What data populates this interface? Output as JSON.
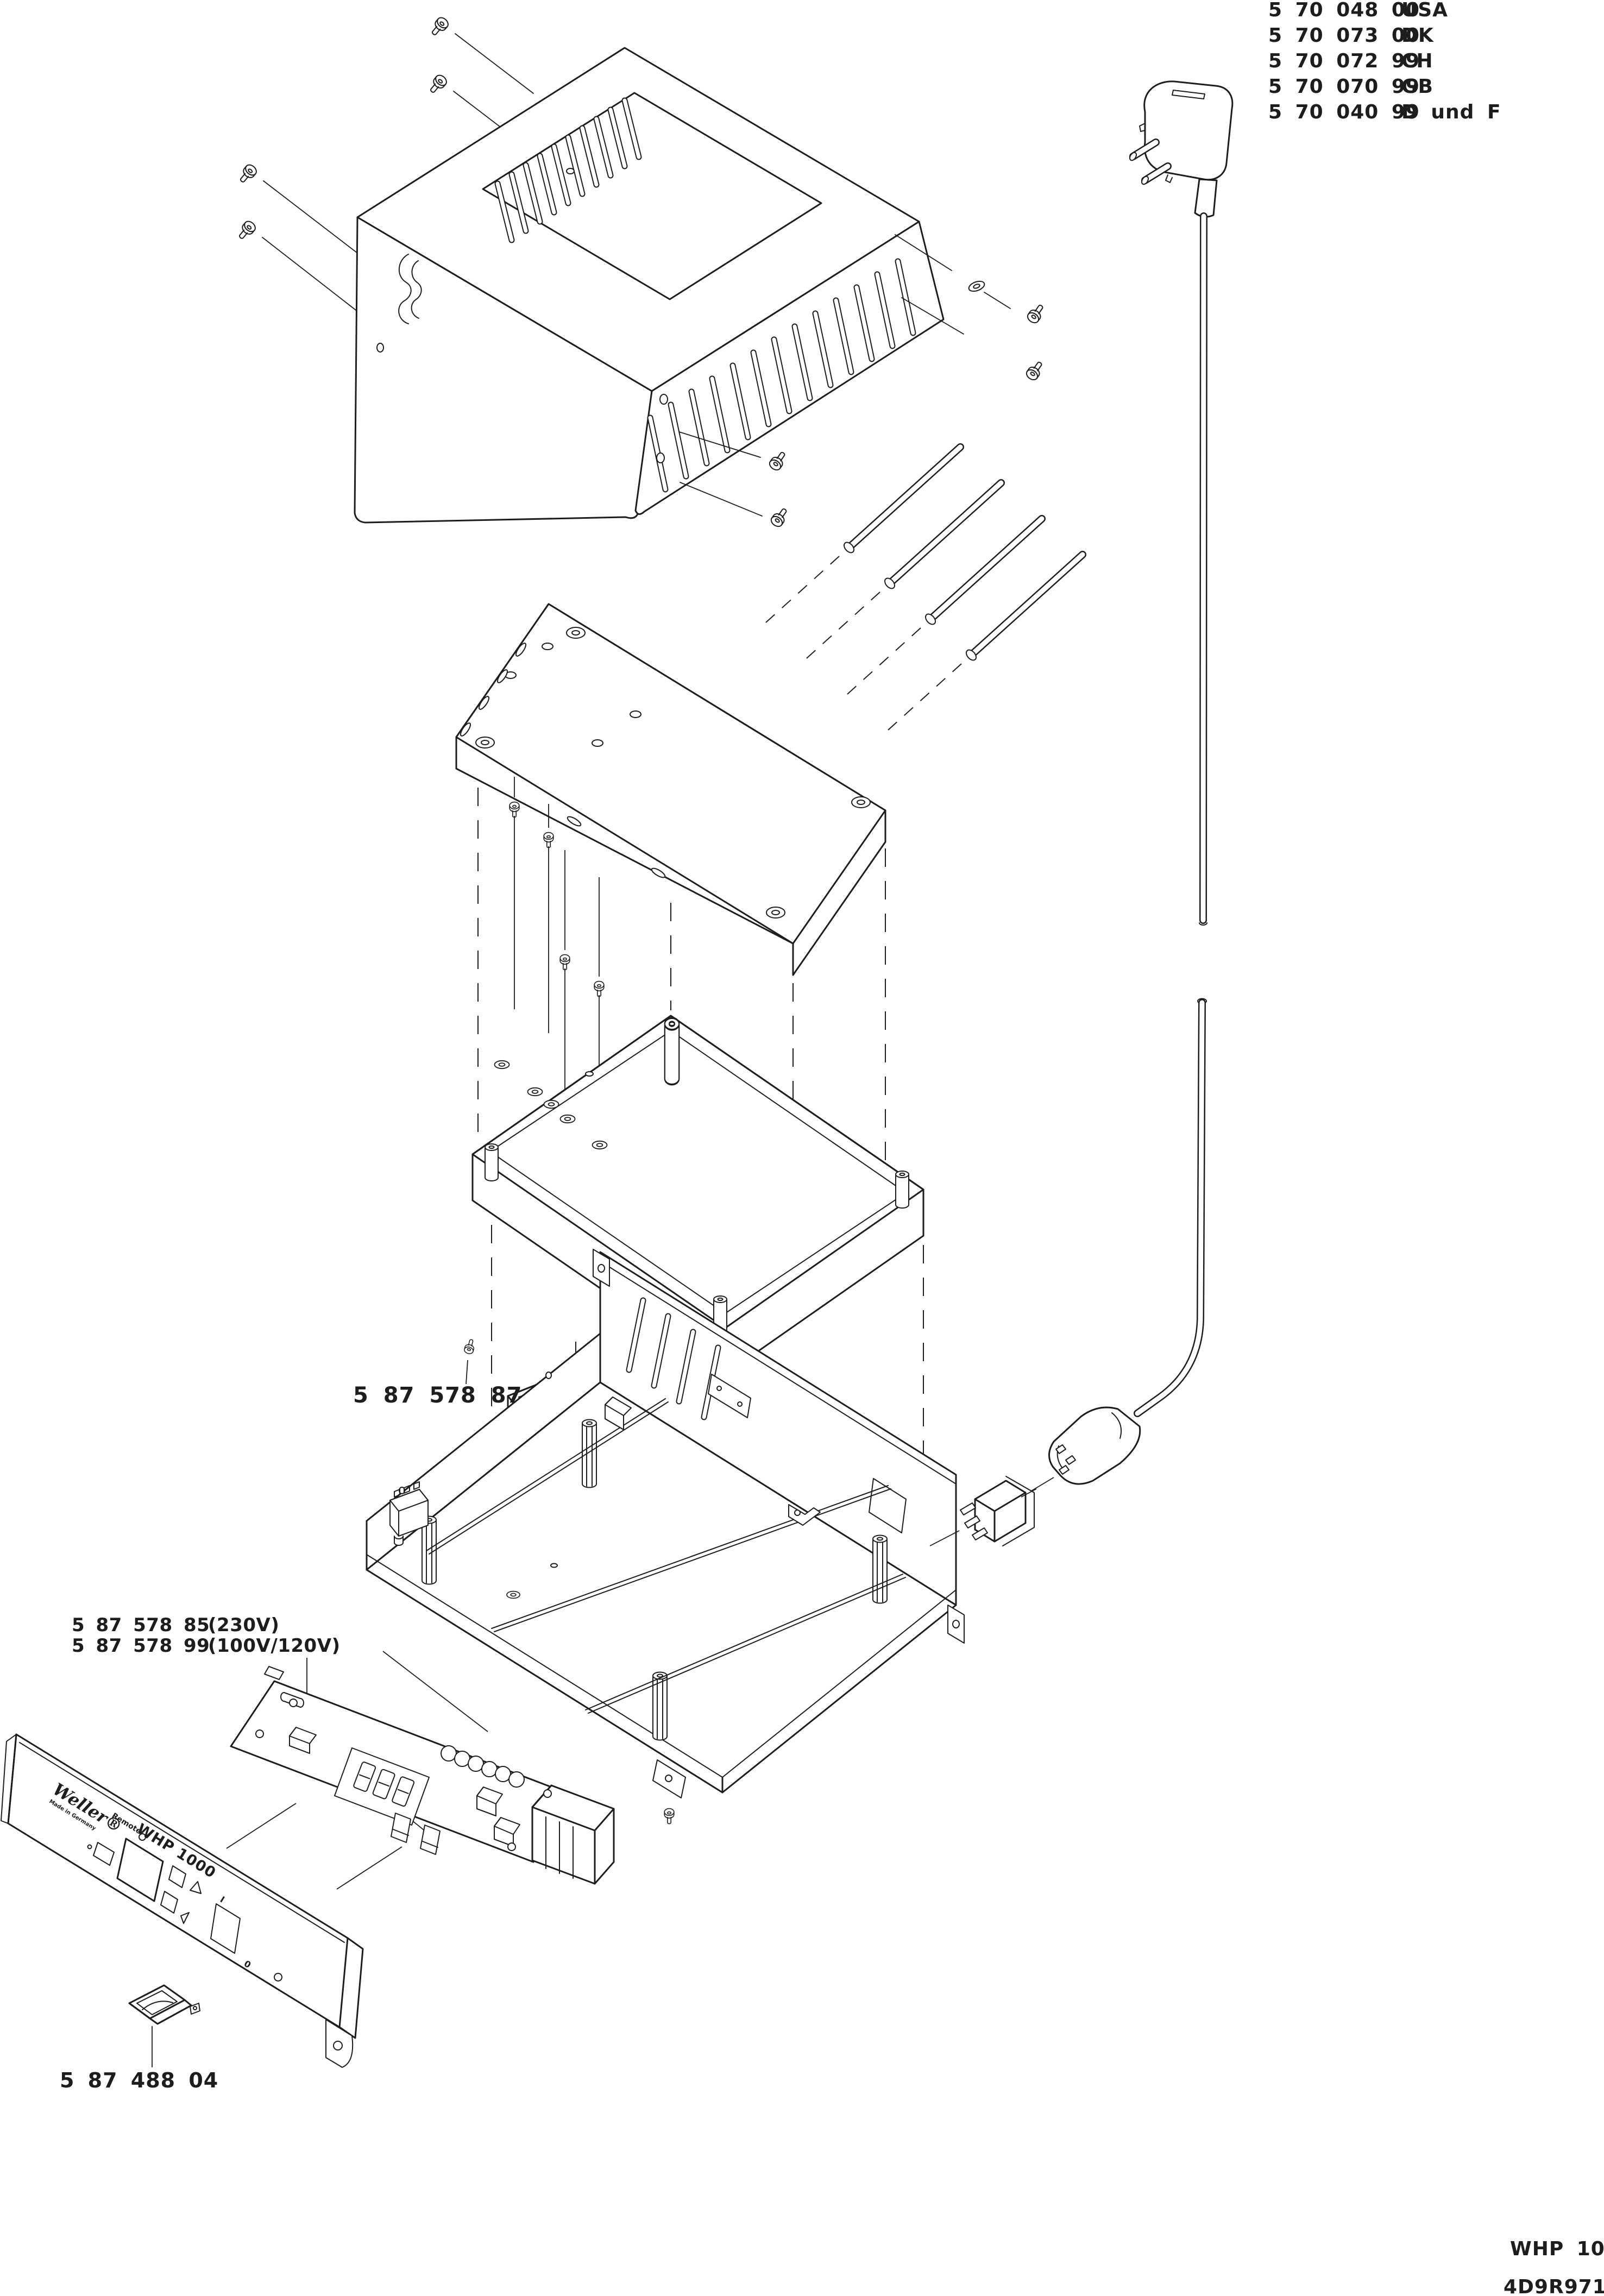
{
  "parts_list": [
    {
      "part_number": "5 70 048 00",
      "region": "USA"
    },
    {
      "part_number": "5 70 073 00",
      "region": "DK"
    },
    {
      "part_number": "5 70 072 99",
      "region": "CH"
    },
    {
      "part_number": "5 70 070 99",
      "region": "GB"
    },
    {
      "part_number": "5 70 040 99",
      "region": "D und F"
    }
  ],
  "part_labels": {
    "terminal_block": "5 87 578 87",
    "control_board_variant_1": {
      "part_number": "5 87 578 85",
      "voltage": "(230V)"
    },
    "control_board_variant_2": {
      "part_number": "5 87 578 99",
      "voltage": "(100V/120V)"
    },
    "power_switch": "5 87 488 04"
  },
  "front_panel": {
    "brand": "Weller®",
    "made_in": "Made in Germany",
    "remote_label": "Remote",
    "model": "WHP 1000",
    "switch_on_mark": "I",
    "switch_off_mark": "0"
  },
  "footer": {
    "model": "WHP 1000",
    "drawing_ref": "4D9R971/2"
  },
  "colors": {
    "line": "#1d1d1d",
    "bg": "#ffffff"
  }
}
